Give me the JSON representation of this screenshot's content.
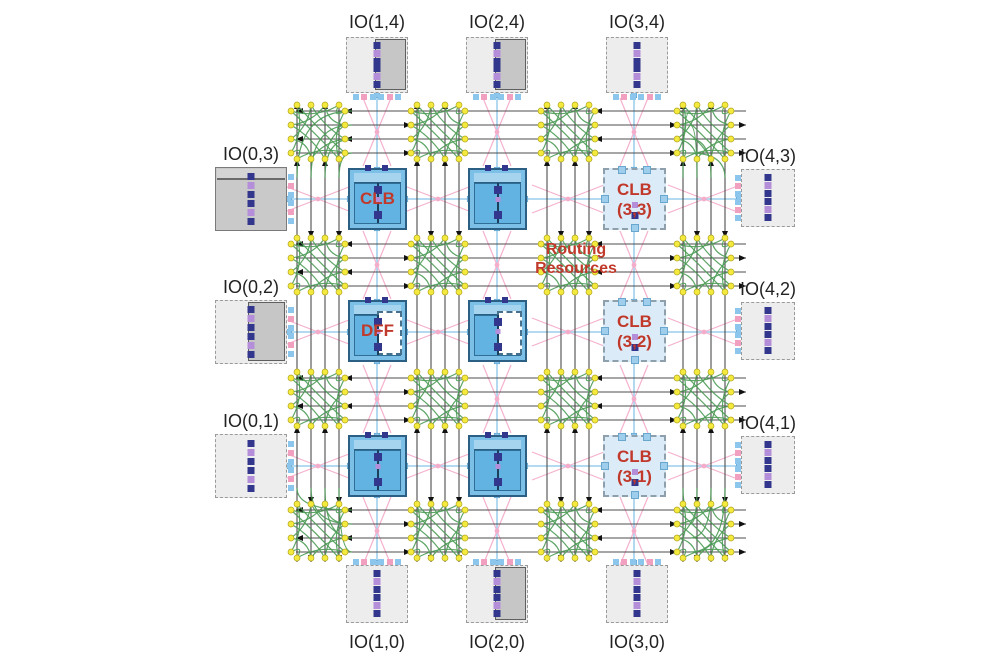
{
  "diagram_title": "FPGA architecture: IO blocks, CLBs and routing resources",
  "io_blocks": [
    {
      "label": "IO(1,4)",
      "side": "top",
      "index": 1,
      "variant": "solid-right"
    },
    {
      "label": "IO(2,4)",
      "side": "top",
      "index": 2,
      "variant": "solid-right"
    },
    {
      "label": "IO(3,4)",
      "side": "top",
      "index": 3,
      "variant": "plain"
    },
    {
      "label": "IO(0,3)",
      "side": "left",
      "index": 3,
      "variant": "solid"
    },
    {
      "label": "IO(0,2)",
      "side": "left",
      "index": 2,
      "variant": "solid-right"
    },
    {
      "label": "IO(0,1)",
      "side": "left",
      "index": 1,
      "variant": "plain"
    },
    {
      "label": "IO(4,3)",
      "side": "right",
      "index": 3,
      "variant": "plain"
    },
    {
      "label": "IO(4,2)",
      "side": "right",
      "index": 2,
      "variant": "plain"
    },
    {
      "label": "IO(4,1)",
      "side": "right",
      "index": 1,
      "variant": "plain"
    },
    {
      "label": "IO(1,0)",
      "side": "bottom",
      "index": 1,
      "variant": "plain"
    },
    {
      "label": "IO(2,0)",
      "side": "bottom",
      "index": 2,
      "variant": "solid-right"
    },
    {
      "label": "IO(3,0)",
      "side": "bottom",
      "index": 3,
      "variant": "plain"
    }
  ],
  "clb_blocks": [
    {
      "col": 1,
      "row": 3,
      "variant": "blue",
      "label": "CLB",
      "sublabel": ""
    },
    {
      "col": 2,
      "row": 3,
      "variant": "blue",
      "label": "",
      "sublabel": ""
    },
    {
      "col": 3,
      "row": 3,
      "variant": "light",
      "label": "CLB",
      "sublabel": "(3,3)"
    },
    {
      "col": 1,
      "row": 2,
      "variant": "blue-dff",
      "label": "DFF",
      "sublabel": ""
    },
    {
      "col": 2,
      "row": 2,
      "variant": "blue-dff",
      "label": "",
      "sublabel": ""
    },
    {
      "col": 3,
      "row": 2,
      "variant": "light",
      "label": "CLB",
      "sublabel": "(3,2)"
    },
    {
      "col": 1,
      "row": 1,
      "variant": "blue",
      "label": "",
      "sublabel": ""
    },
    {
      "col": 2,
      "row": 1,
      "variant": "blue",
      "label": "",
      "sublabel": ""
    },
    {
      "col": 3,
      "row": 1,
      "variant": "light",
      "label": "CLB",
      "sublabel": "(3,1)"
    }
  ],
  "annotations": {
    "routing_line1": "Routing",
    "routing_line2": "Resources"
  },
  "colors": {
    "red_label": "#c0392b",
    "track": "#4d4d4d",
    "green": "#4c9b57",
    "yellow": "#f3ea3d",
    "yellow_stroke": "#b3a51f",
    "pink": "#f4accb",
    "light_blue": "#a9d5ef",
    "pin_blue": "#8cc6ec",
    "pin_pink": "#f2a0bf",
    "navy": "#32368c",
    "violet": "#b48ed8",
    "label_text": "#222222"
  }
}
